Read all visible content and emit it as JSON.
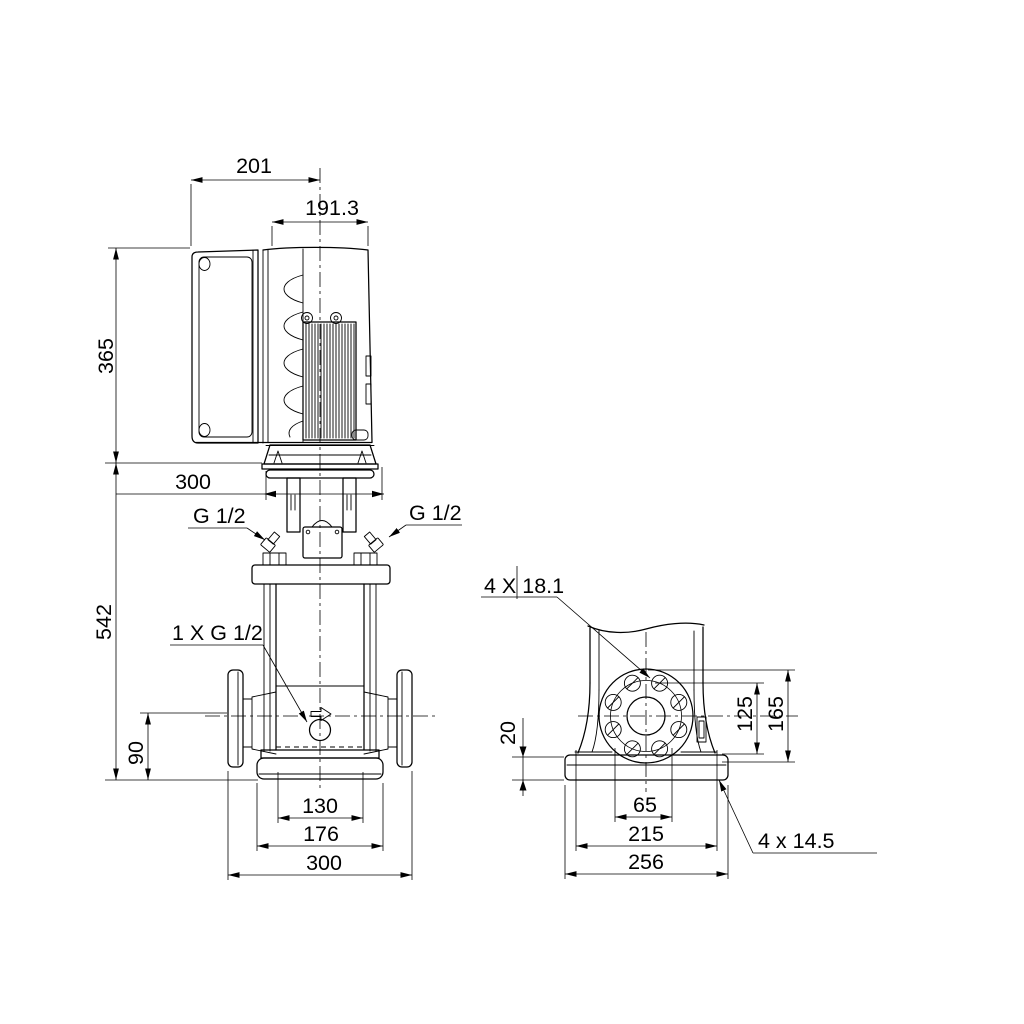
{
  "front_view": {
    "dim_motor_width_total": "201",
    "dim_motor_width": "191.3",
    "dim_motor_height": "365",
    "dim_head_width": "300",
    "dim_pump_height": "542",
    "dim_port_height": "90",
    "dim_base_hole_spacing": "130",
    "dim_base_width": "176",
    "dim_port_to_port": "300",
    "label_plug_left": "G 1/2",
    "label_plug_right": "G 1/2",
    "label_drain_plug": "1 X G 1/2"
  },
  "side_view": {
    "label_flange_bolt_holes": "4 X 18.1",
    "dim_baseplate_thickness": "20",
    "dim_flange_center_inner": "125",
    "dim_flange_center_outer": "165",
    "dim_base_slot_spacing": "65",
    "dim_base_hole_spacing": "215",
    "dim_base_depth": "256",
    "label_base_holes": "4 x 14.5"
  }
}
